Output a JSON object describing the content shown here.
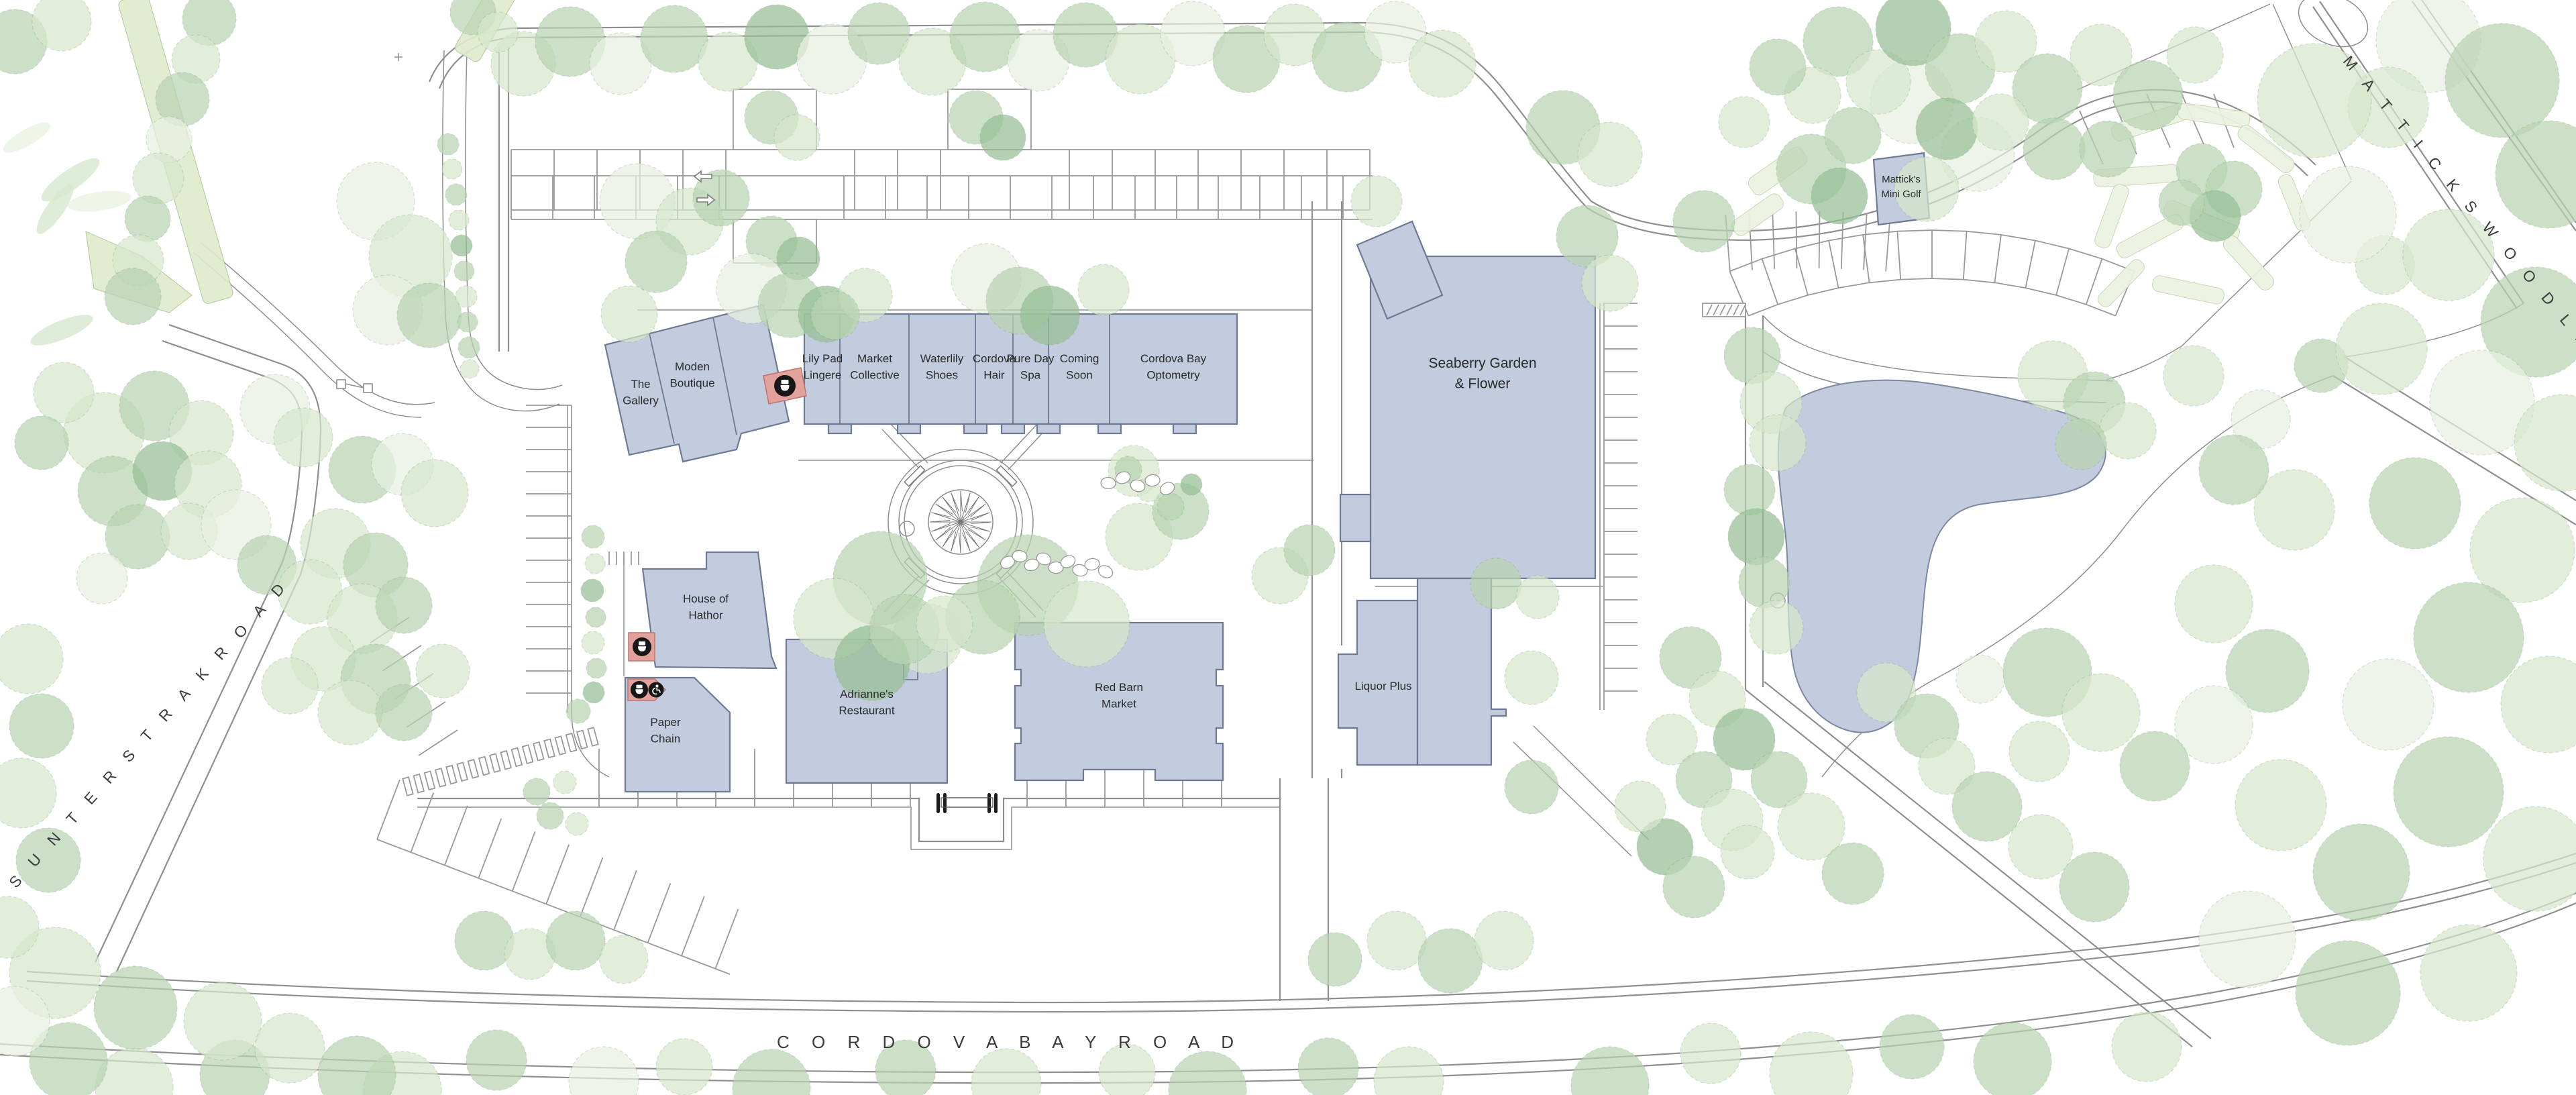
{
  "map": {
    "type": "shopping-centre site plan",
    "background": "#ffffff"
  },
  "buildings": {
    "the_gallery": {
      "label": "The\nGallery"
    },
    "moden_boutique": {
      "label": "Moden\nBoutique"
    },
    "lily_pad_lingere": {
      "label": "Lily Pad\nLingere"
    },
    "market_collective": {
      "label": "Market\nCollective"
    },
    "waterlily_shoes": {
      "label": "Waterlily\nShoes"
    },
    "cordova_hair": {
      "label": "Cordova\nHair"
    },
    "pure_day_spa": {
      "label": "Pure Day\nSpa"
    },
    "coming_soon": {
      "label": "Coming\nSoon"
    },
    "cordova_bay_optometry": {
      "label": "Cordova Bay\nOptometry"
    },
    "seaberry_garden_flower": {
      "label": "Seaberry Garden\n& Flower"
    },
    "matticks_mini_golf": {
      "label": "Mattick's\nMini Golf"
    },
    "house_of_hathor": {
      "label": "House of\nHathor"
    },
    "paper_chain": {
      "label": "Paper\nChain"
    },
    "adriannes_restaurant": {
      "label": "Adrianne's\nRestaurant"
    },
    "red_barn_market": {
      "label": "Red Barn\nMarket"
    },
    "liquor_plus": {
      "label": "Liquor Plus"
    }
  },
  "roads": {
    "cordova_bay_road": "C O R D O V A   B A Y   R O A D",
    "sunters_trak_road": "S U N T E R S   T R A K   R O A D",
    "matticks_wood_lane": "M A T T I C K S   W O O D   L A N E"
  },
  "icons": {
    "washroom": "toilet-icon",
    "accessible_washroom": "wheelchair-icon",
    "traffic_arrows": [
      "arrow-left-icon",
      "arrow-right-icon"
    ]
  },
  "colors": {
    "building": "#c3cbde",
    "building_outline": "#6e7a94",
    "washroom_marker": "#e2a19b",
    "icon_disc": "#171717",
    "tree_pale": "#e9f1e2",
    "tree_light": "#d7e7cd",
    "tree_mid": "#b9d4b2",
    "tree_dark": "#96c095",
    "hedge": "#dfeccb",
    "road_line": "#8f8f8f",
    "label": "#2a2a2a"
  }
}
